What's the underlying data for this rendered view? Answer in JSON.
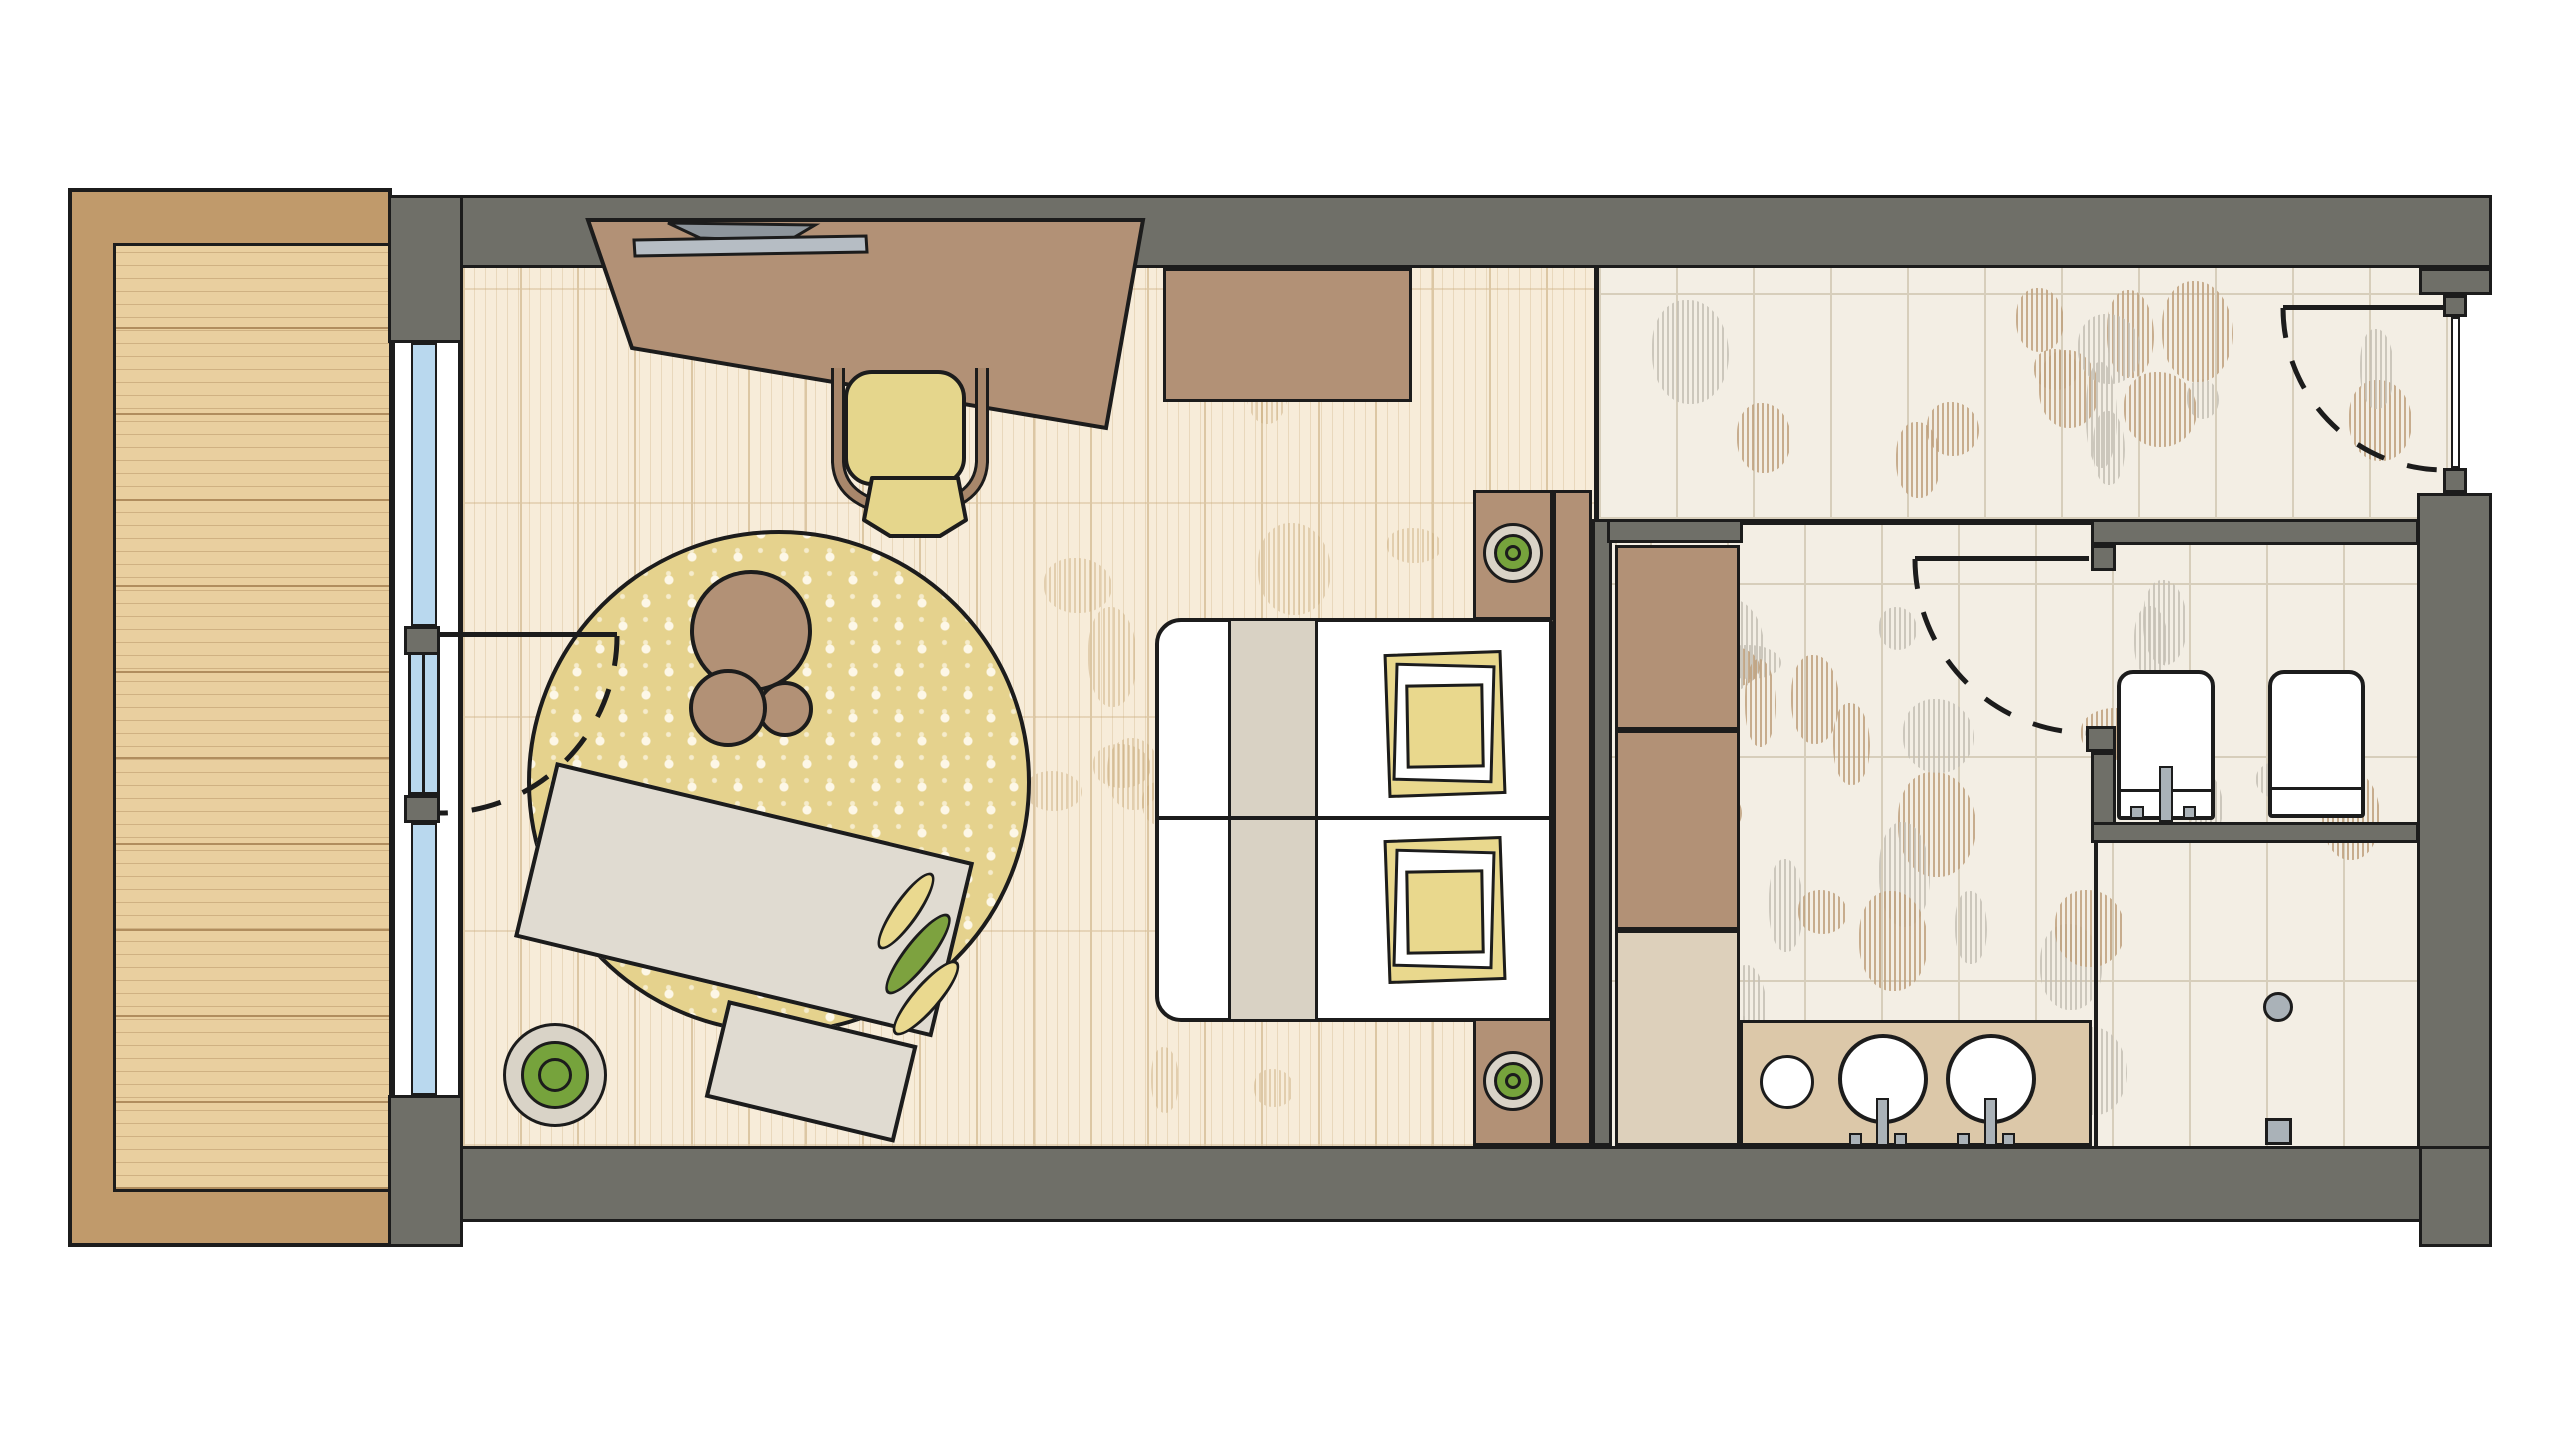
{
  "colors": {
    "ink": "#1c1c1c",
    "wall": "#6f6f68",
    "balconyFrame": "#c09a6b",
    "deck": "#e9cf9f",
    "deckLine": "#b08d5e",
    "glass": "#b9d8ee",
    "woodFloor": "#f7ecd9",
    "woodLine": "#dcc7a4",
    "woodGrain": "#c8a979",
    "tile": "#f3eee4",
    "tileLine": "#d7cebb",
    "hatchGray": "#c5c0b5",
    "hatchTan": "#bfa17e",
    "rug": "#e5d28d",
    "rugDot": "#fdf7e7",
    "sofa": "#e0dbd1",
    "cushionYellow": "#ead98f",
    "cushionGreen": "#7da23f",
    "furnBrown": "#b29176",
    "chairYellow": "#e5d68c",
    "chairArm": "#a8876b",
    "bedWhite": "#ffffff",
    "runner": "#d9d2c4",
    "pillow": "#e9d88d",
    "beigeShelf": "#ddd0bb",
    "counter": "#dcc8a9",
    "plantGreen": "#76a33c",
    "potRing": "#d9d3c7",
    "metal": "#aab2b8",
    "laptop": "#b6bdc4",
    "laptopScreen": "#8d959c"
  },
  "legend": {
    "drawing": "hotel-room-floor-plan-top-view",
    "rooms": [
      "balcony",
      "bedroom",
      "entry-corridor",
      "bathroom",
      "wc",
      "shower"
    ],
    "furniture": [
      "balcony-deck",
      "window-wall",
      "balcony-door",
      "desk",
      "laptop",
      "desk-chair",
      "luggage-bench",
      "round-rug",
      "coffee-table-set",
      "sofa-with-chaise",
      "leaf-cushions",
      "floor-plant",
      "double-bed",
      "duvet-runner",
      "pillows",
      "headboard",
      "nightstand-with-plant",
      "wardrobe-shelves",
      "vanity-counter",
      "washbasins",
      "faucets",
      "toilet",
      "bidet",
      "shower-drain",
      "entry-door",
      "wc-door"
    ]
  },
  "decor": {
    "hatch_seed": 11,
    "hatch_regions": [
      {
        "x": 480,
        "y": 285,
        "w": 1085,
        "h": 840,
        "count": 18,
        "mode": "wood"
      },
      {
        "x": 1615,
        "y": 280,
        "w": 800,
        "h": 222,
        "count": 16,
        "mode": "tile"
      },
      {
        "x": 1625,
        "y": 556,
        "w": 780,
        "h": 572,
        "count": 32,
        "mode": "tile"
      }
    ]
  }
}
